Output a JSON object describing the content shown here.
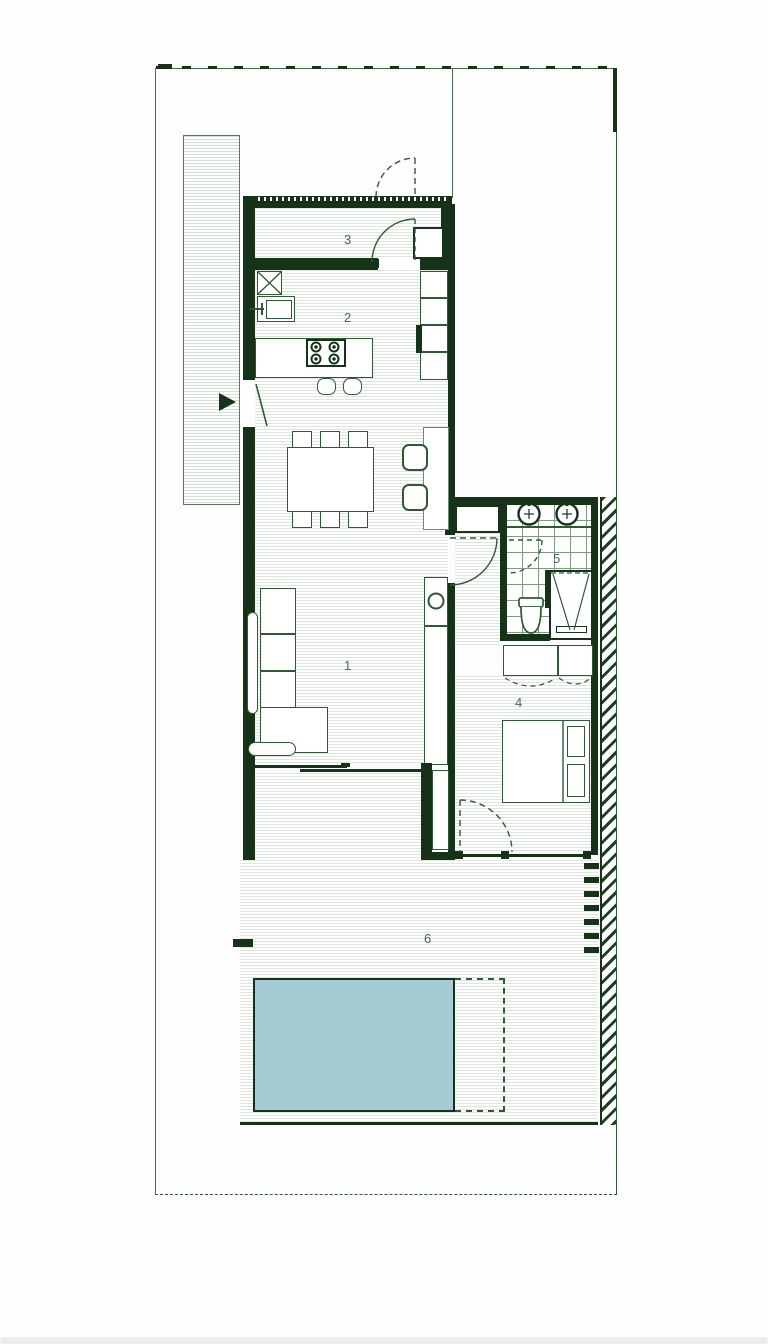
{
  "plan": {
    "type": "architectural-floor-plan",
    "rooms": [
      {
        "id": "living-room",
        "number": "1"
      },
      {
        "id": "kitchen",
        "number": "2"
      },
      {
        "id": "entry-storage",
        "number": "3"
      },
      {
        "id": "bedroom",
        "number": "4"
      },
      {
        "id": "bathroom",
        "number": "5"
      },
      {
        "id": "terrace",
        "number": "6"
      }
    ],
    "fixtures": [
      "entry-arrow",
      "dining-table",
      "l-sofa",
      "kitchen-island",
      "cooktop",
      "bar-stools",
      "wall-cabinets",
      "desk",
      "desk-chairs",
      "tv-column",
      "double-bed",
      "wardrobe",
      "double-washbasin",
      "toilet",
      "shower",
      "swing-doors",
      "sliding-glass-doors",
      "swimming-pool",
      "pool-deck",
      "driveway-strip",
      "boundary-fence",
      "hatched-party-wall"
    ],
    "colors": {
      "wall": "#16331a",
      "line": "#2e5a33",
      "floor_stripe": "#dde6dd",
      "tile_line": "#7d9b7d",
      "pool_fill": "#a5ccd4",
      "label": "#4a626d"
    }
  }
}
